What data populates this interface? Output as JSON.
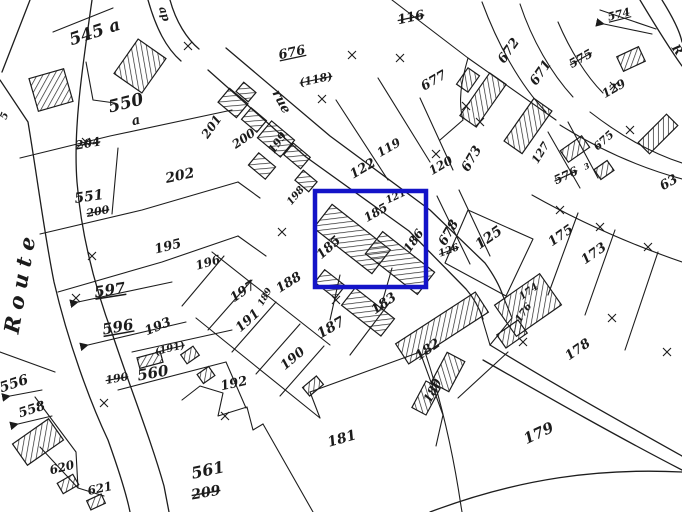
{
  "map": {
    "type": "cadastral-plan",
    "ink_color": "#1b1b1b",
    "highlight": {
      "color": "#1414c8",
      "x": 315,
      "y": 191,
      "width": 111,
      "height": 96,
      "stroke_width": 4.5
    },
    "road_labels": [
      {
        "text": "Route",
        "x": 22,
        "y": 282,
        "rot": -80,
        "size": 21,
        "ls": 7,
        "weight": 600
      },
      {
        "text": "rue",
        "x": 281,
        "y": 102,
        "rot": 62,
        "size": 13,
        "weight": 600
      },
      {
        "text": "ap",
        "x": 164,
        "y": 14,
        "rot": 72,
        "size": 11,
        "weight": 600
      },
      {
        "text": "R",
        "x": 677,
        "y": 50,
        "rot": 55,
        "size": 12,
        "weight": 600
      },
      {
        "text": "5",
        "x": 5,
        "y": 116,
        "rot": -70,
        "size": 10,
        "weight": 600
      }
    ],
    "parcel_labels": [
      {
        "text": "545 a",
        "x": 95,
        "y": 33,
        "rot": -18,
        "size": 17,
        "weight": 700
      },
      {
        "text": "550",
        "x": 126,
        "y": 104,
        "rot": -14,
        "size": 17,
        "weight": 700
      },
      {
        "text": "a",
        "x": 136,
        "y": 121,
        "rot": -14,
        "size": 13,
        "weight": 700
      },
      {
        "text": "551",
        "x": 89,
        "y": 197,
        "rot": -8,
        "size": 14,
        "weight": 700
      },
      {
        "text": "202",
        "x": 180,
        "y": 176,
        "rot": -12,
        "size": 14,
        "weight": 600
      },
      {
        "text": "195",
        "x": 168,
        "y": 247,
        "rot": -14,
        "size": 13,
        "weight": 600
      },
      {
        "text": "196",
        "x": 208,
        "y": 263,
        "rot": -16,
        "size": 12,
        "weight": 600
      },
      {
        "text": "197",
        "x": 243,
        "y": 292,
        "rot": -35,
        "size": 13,
        "weight": 600
      },
      {
        "text": "597",
        "x": 110,
        "y": 291,
        "rot": -9,
        "size": 15,
        "weight": 700,
        "style": "underline"
      },
      {
        "text": "596",
        "x": 118,
        "y": 328,
        "rot": -10,
        "size": 15,
        "weight": 700,
        "style": "underline"
      },
      {
        "text": "193",
        "x": 158,
        "y": 327,
        "rot": -22,
        "size": 13,
        "weight": 600
      },
      {
        "text": "560",
        "x": 153,
        "y": 374,
        "rot": -10,
        "size": 15,
        "weight": 700
      },
      {
        "text": "556",
        "x": 14,
        "y": 384,
        "rot": -18,
        "size": 14,
        "weight": 700
      },
      {
        "text": "558",
        "x": 32,
        "y": 410,
        "rot": -18,
        "size": 13,
        "weight": 700
      },
      {
        "text": "620",
        "x": 62,
        "y": 468,
        "rot": -14,
        "size": 12,
        "weight": 600
      },
      {
        "text": "621",
        "x": 100,
        "y": 489,
        "rot": -12,
        "size": 12,
        "weight": 600
      },
      {
        "text": "561",
        "x": 208,
        "y": 471,
        "rot": -12,
        "size": 16,
        "weight": 700
      },
      {
        "text": "192",
        "x": 234,
        "y": 384,
        "rot": -12,
        "size": 13,
        "weight": 600
      },
      {
        "text": "190",
        "x": 293,
        "y": 359,
        "rot": -40,
        "size": 13,
        "weight": 600
      },
      {
        "text": "191",
        "x": 248,
        "y": 321,
        "rot": -42,
        "size": 13,
        "weight": 600
      },
      {
        "text": "188",
        "x": 289,
        "y": 283,
        "rot": -32,
        "size": 13,
        "weight": 600
      },
      {
        "text": "189",
        "x": 265,
        "y": 297,
        "rot": -60,
        "size": 9,
        "weight": 600
      },
      {
        "text": "187",
        "x": 331,
        "y": 328,
        "rot": -30,
        "size": 14,
        "weight": 600
      },
      {
        "text": "183",
        "x": 384,
        "y": 304,
        "rot": -35,
        "size": 13,
        "weight": 600
      },
      {
        "text": "185",
        "x": 329,
        "y": 248,
        "rot": -42,
        "size": 13,
        "weight": 600
      },
      {
        "text": "185",
        "x": 376,
        "y": 213,
        "rot": -30,
        "size": 12,
        "weight": 600
      },
      {
        "text": "186",
        "x": 414,
        "y": 241,
        "rot": -55,
        "size": 12,
        "weight": 600
      },
      {
        "text": "121",
        "x": 396,
        "y": 197,
        "rot": -25,
        "size": 10,
        "weight": 600
      },
      {
        "text": "122",
        "x": 363,
        "y": 169,
        "rot": -30,
        "size": 13,
        "weight": 600
      },
      {
        "text": "119",
        "x": 389,
        "y": 148,
        "rot": -30,
        "size": 12,
        "weight": 600
      },
      {
        "text": "120",
        "x": 441,
        "y": 166,
        "rot": -30,
        "size": 12,
        "weight": 600
      },
      {
        "text": "676",
        "x": 292,
        "y": 53,
        "rot": -12,
        "size": 13,
        "weight": 600,
        "style": "underline"
      },
      {
        "text": "677",
        "x": 434,
        "y": 81,
        "rot": -30,
        "size": 13,
        "weight": 600
      },
      {
        "text": "672",
        "x": 509,
        "y": 51,
        "rot": -55,
        "size": 13,
        "weight": 600
      },
      {
        "text": "671",
        "x": 541,
        "y": 73,
        "rot": -55,
        "size": 13,
        "weight": 600
      },
      {
        "text": "574",
        "x": 619,
        "y": 15,
        "rot": -14,
        "size": 11,
        "weight": 700,
        "style": "underline"
      },
      {
        "text": "129",
        "x": 614,
        "y": 89,
        "rot": -30,
        "size": 12,
        "weight": 600
      },
      {
        "text": "675",
        "x": 604,
        "y": 141,
        "rot": -42,
        "size": 11,
        "weight": 600
      },
      {
        "text": "3",
        "x": 587,
        "y": 167,
        "rot": -25,
        "size": 8,
        "weight": 600
      },
      {
        "text": "127",
        "x": 541,
        "y": 153,
        "rot": -58,
        "size": 11,
        "weight": 600
      },
      {
        "text": "673",
        "x": 472,
        "y": 159,
        "rot": -60,
        "size": 13,
        "weight": 600
      },
      {
        "text": "678",
        "x": 449,
        "y": 233,
        "rot": -60,
        "size": 13,
        "weight": 600
      },
      {
        "text": "125",
        "x": 489,
        "y": 238,
        "rot": -35,
        "size": 14,
        "weight": 600
      },
      {
        "text": "175",
        "x": 561,
        "y": 236,
        "rot": -35,
        "size": 13,
        "weight": 600
      },
      {
        "text": "173",
        "x": 594,
        "y": 254,
        "rot": -35,
        "size": 13,
        "weight": 600
      },
      {
        "text": "63",
        "x": 669,
        "y": 183,
        "rot": -30,
        "size": 13,
        "weight": 600
      },
      {
        "text": "174",
        "x": 529,
        "y": 292,
        "rot": -35,
        "size": 10,
        "weight": 600
      },
      {
        "text": "176",
        "x": 524,
        "y": 313,
        "rot": -55,
        "size": 10,
        "weight": 600
      },
      {
        "text": "178",
        "x": 578,
        "y": 350,
        "rot": -35,
        "size": 13,
        "weight": 600
      },
      {
        "text": "179",
        "x": 539,
        "y": 434,
        "rot": -25,
        "size": 15,
        "weight": 600
      },
      {
        "text": "182",
        "x": 428,
        "y": 350,
        "rot": -35,
        "size": 13,
        "weight": 600
      },
      {
        "text": "180",
        "x": 433,
        "y": 391,
        "rot": -62,
        "size": 12,
        "weight": 600
      },
      {
        "text": "181",
        "x": 342,
        "y": 439,
        "rot": -16,
        "size": 14,
        "weight": 600
      },
      {
        "text": "201",
        "x": 212,
        "y": 127,
        "rot": -55,
        "size": 12,
        "weight": 600
      },
      {
        "text": "200",
        "x": 244,
        "y": 139,
        "rot": -35,
        "size": 12,
        "weight": 600
      },
      {
        "text": "199",
        "x": 278,
        "y": 143,
        "rot": -55,
        "size": 11,
        "weight": 600
      },
      {
        "text": "198",
        "x": 296,
        "y": 196,
        "rot": -50,
        "size": 10,
        "weight": 600
      }
    ],
    "old_parcel_labels": [
      {
        "text": "204",
        "x": 88,
        "y": 144,
        "rot": -10,
        "size": 12,
        "weight": 600,
        "style": "strike"
      },
      {
        "text": "200",
        "x": 98,
        "y": 212,
        "rot": -10,
        "size": 11,
        "weight": 600,
        "style": "strike"
      },
      {
        "text": "190",
        "x": 117,
        "y": 379,
        "rot": -10,
        "size": 11,
        "weight": 600,
        "style": "strike"
      },
      {
        "text": "(191)",
        "x": 170,
        "y": 349,
        "rot": -14,
        "size": 10,
        "weight": 600,
        "style": "strike"
      },
      {
        "text": "209",
        "x": 206,
        "y": 493,
        "rot": -10,
        "size": 14,
        "weight": 700,
        "style": "strike"
      },
      {
        "text": "116",
        "x": 411,
        "y": 18,
        "rot": -12,
        "size": 13,
        "weight": 600,
        "style": "strike"
      },
      {
        "text": "(118)",
        "x": 316,
        "y": 80,
        "rot": -12,
        "size": 11,
        "weight": 600,
        "style": "strike"
      },
      {
        "text": "575",
        "x": 581,
        "y": 59,
        "rot": -30,
        "size": 12,
        "weight": 700,
        "style": "strike"
      },
      {
        "text": "576",
        "x": 566,
        "y": 176,
        "rot": -25,
        "size": 12,
        "weight": 600,
        "style": "strike"
      },
      {
        "text": "126",
        "x": 449,
        "y": 251,
        "rot": -20,
        "size": 10,
        "weight": 600,
        "style": "strike"
      }
    ]
  }
}
